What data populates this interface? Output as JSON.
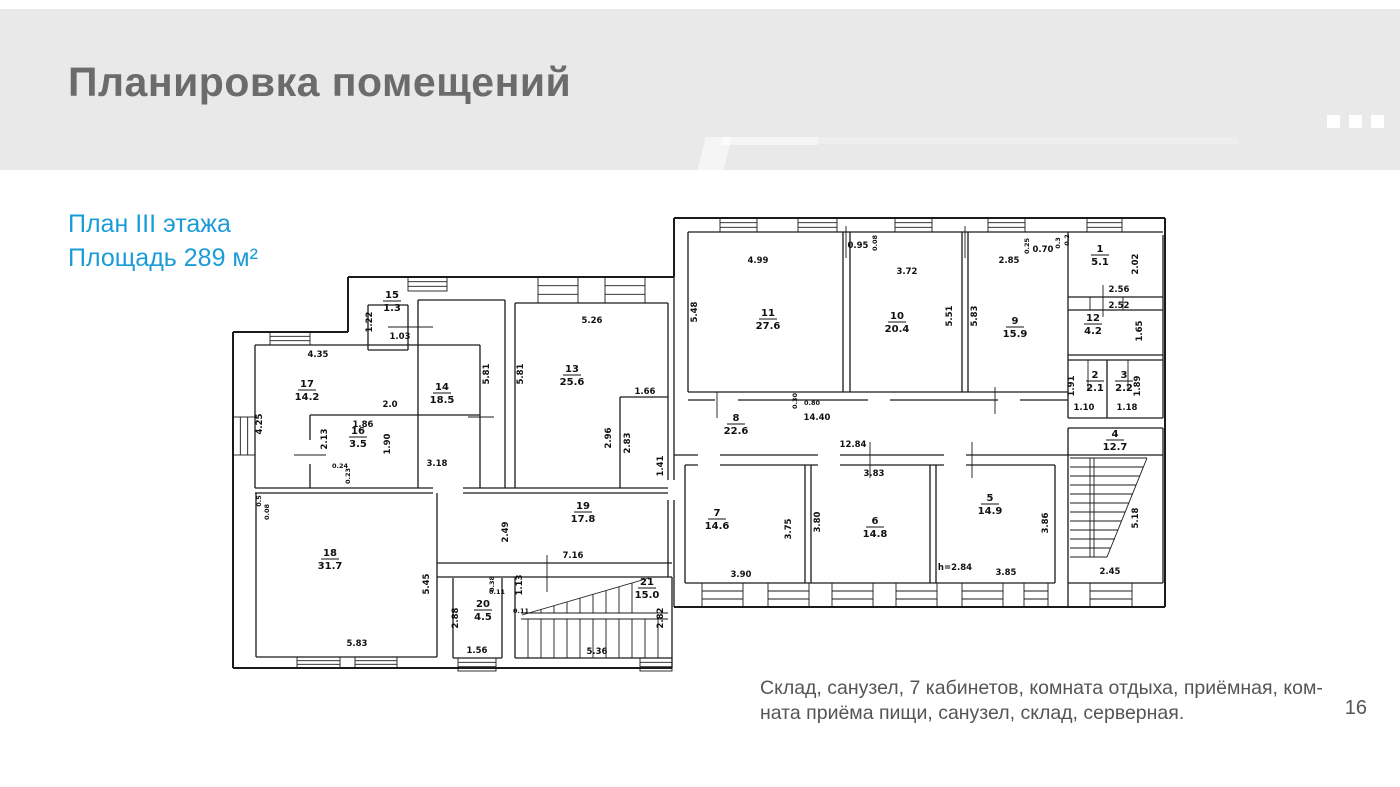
{
  "slide": {
    "title": "Планировка помещений",
    "subtitle_lines": [
      "План III этажа",
      "Площадь 289 м²"
    ],
    "caption_lines": [
      "Склад, санузел, 7 кабинетов, комната отдыха, приёмная, ком-",
      "ната приёма пищи, санузел, склад, серверная."
    ],
    "page_number": "16",
    "colors": {
      "accent": "#1b9cd8",
      "title": "#6b6b6b",
      "header_bg": "#e9e9e9",
      "caption": "#555555",
      "plan_line": "#1b1b1b"
    }
  },
  "floor_plan": {
    "rooms": [
      {
        "n": "17",
        "a": "14.2",
        "x": 79,
        "y": 185
      },
      {
        "n": "16",
        "a": "3.5",
        "x": 130,
        "y": 232
      },
      {
        "n": "15",
        "a": "1.3",
        "x": 164,
        "y": 96
      },
      {
        "n": "14",
        "a": "18.5",
        "x": 214,
        "y": 188
      },
      {
        "n": "13",
        "a": "25.6",
        "x": 344,
        "y": 170
      },
      {
        "n": "18",
        "a": "31.7",
        "x": 102,
        "y": 354
      },
      {
        "n": "19",
        "a": "17.8",
        "x": 355,
        "y": 307
      },
      {
        "n": "20",
        "a": "4.5",
        "x": 255,
        "y": 405
      },
      {
        "n": "21",
        "a": "15.0",
        "x": 419,
        "y": 383
      },
      {
        "n": "11",
        "a": "27.6",
        "x": 540,
        "y": 114
      },
      {
        "n": "10",
        "a": "20.4",
        "x": 669,
        "y": 117
      },
      {
        "n": "9",
        "a": "15.9",
        "x": 787,
        "y": 122
      },
      {
        "n": "8",
        "a": "22.6",
        "x": 508,
        "y": 219
      },
      {
        "n": "7",
        "a": "14.6",
        "x": 489,
        "y": 314
      },
      {
        "n": "6",
        "a": "14.8",
        "x": 647,
        "y": 322
      },
      {
        "n": "5",
        "a": "14.9",
        "x": 762,
        "y": 299
      },
      {
        "n": "4",
        "a": "12.7",
        "x": 887,
        "y": 235
      },
      {
        "n": "1",
        "a": "5.1",
        "x": 872,
        "y": 50
      },
      {
        "n": "12",
        "a": "4.2",
        "x": 865,
        "y": 119
      },
      {
        "n": "2",
        "a": "2.1",
        "x": 867,
        "y": 176
      },
      {
        "n": "3",
        "a": "2.2",
        "x": 896,
        "y": 176
      }
    ],
    "dimensions": [
      {
        "t": "4.35",
        "x": 90,
        "y": 155
      },
      {
        "t": "4.25",
        "x": 34,
        "y": 222,
        "r": 1
      },
      {
        "t": "2.0",
        "x": 162,
        "y": 205
      },
      {
        "t": "1.86",
        "x": 135,
        "y": 225
      },
      {
        "t": "2.13",
        "x": 99,
        "y": 237,
        "r": 1
      },
      {
        "t": "1.90",
        "x": 162,
        "y": 242,
        "r": 1
      },
      {
        "t": "0.24",
        "x": 112,
        "y": 266,
        "s": 1
      },
      {
        "t": "0.23",
        "x": 122,
        "y": 274,
        "r": 1,
        "s": 1
      },
      {
        "t": "1.22",
        "x": 144,
        "y": 120,
        "r": 1
      },
      {
        "t": "1.03",
        "x": 172,
        "y": 137
      },
      {
        "t": "5.81",
        "x": 261,
        "y": 172,
        "r": 1
      },
      {
        "t": "5.81",
        "x": 295,
        "y": 172,
        "r": 1
      },
      {
        "t": "3.18",
        "x": 209,
        "y": 264
      },
      {
        "t": "5.26",
        "x": 364,
        "y": 121
      },
      {
        "t": "1.66",
        "x": 417,
        "y": 192
      },
      {
        "t": "2.96",
        "x": 383,
        "y": 236,
        "r": 1
      },
      {
        "t": "2.83",
        "x": 402,
        "y": 241,
        "r": 1
      },
      {
        "t": "1.41",
        "x": 435,
        "y": 264,
        "r": 1
      },
      {
        "t": "5.48",
        "x": 469,
        "y": 110,
        "r": 1
      },
      {
        "t": "4.99",
        "x": 530,
        "y": 61
      },
      {
        "t": "3.72",
        "x": 679,
        "y": 72
      },
      {
        "t": "0.95",
        "x": 630,
        "y": 46
      },
      {
        "t": "0.08",
        "x": 649,
        "y": 41,
        "r": 1,
        "s": 1
      },
      {
        "t": "5.51",
        "x": 724,
        "y": 114,
        "r": 1
      },
      {
        "t": "5.83",
        "x": 749,
        "y": 114,
        "r": 1
      },
      {
        "t": "2.85",
        "x": 781,
        "y": 61
      },
      {
        "t": "0.70",
        "x": 815,
        "y": 50
      },
      {
        "t": "0.25",
        "x": 801,
        "y": 44,
        "r": 1,
        "s": 1
      },
      {
        "t": "0.3",
        "x": 832,
        "y": 41,
        "r": 1,
        "s": 1
      },
      {
        "t": "0.2",
        "x": 841,
        "y": 38,
        "r": 1,
        "s": 1
      },
      {
        "t": "2.02",
        "x": 910,
        "y": 62,
        "r": 1
      },
      {
        "t": "2.56",
        "x": 891,
        "y": 90
      },
      {
        "t": "2.52",
        "x": 891,
        "y": 106
      },
      {
        "t": "1.65",
        "x": 914,
        "y": 129,
        "r": 1
      },
      {
        "t": "1.91",
        "x": 846,
        "y": 184,
        "r": 1
      },
      {
        "t": "1.10",
        "x": 856,
        "y": 208
      },
      {
        "t": "1.89",
        "x": 912,
        "y": 184,
        "r": 1
      },
      {
        "t": "1.18",
        "x": 899,
        "y": 208
      },
      {
        "t": "14.40",
        "x": 589,
        "y": 218
      },
      {
        "t": "12.84",
        "x": 625,
        "y": 245
      },
      {
        "t": "0.30",
        "x": 569,
        "y": 199,
        "r": 1,
        "s": 1
      },
      {
        "t": "0.80",
        "x": 584,
        "y": 203,
        "s": 1
      },
      {
        "t": "3.83",
        "x": 646,
        "y": 274
      },
      {
        "t": "3.75",
        "x": 563,
        "y": 327,
        "r": 1
      },
      {
        "t": "3.80",
        "x": 592,
        "y": 320,
        "r": 1
      },
      {
        "t": "3.90",
        "x": 513,
        "y": 375
      },
      {
        "t": "3.86",
        "x": 820,
        "y": 321,
        "r": 1
      },
      {
        "t": "h=2.84",
        "x": 727,
        "y": 368
      },
      {
        "t": "3.85",
        "x": 778,
        "y": 373
      },
      {
        "t": "5.18",
        "x": 910,
        "y": 316,
        "r": 1
      },
      {
        "t": "2.45",
        "x": 882,
        "y": 372
      },
      {
        "t": "2.49",
        "x": 280,
        "y": 330,
        "r": 1
      },
      {
        "t": "7.16",
        "x": 345,
        "y": 356
      },
      {
        "t": "5.45",
        "x": 201,
        "y": 382,
        "r": 1
      },
      {
        "t": "0.5",
        "x": 33,
        "y": 299,
        "r": 1,
        "s": 1
      },
      {
        "t": "0.08",
        "x": 41,
        "y": 310,
        "r": 1,
        "s": 1
      },
      {
        "t": "5.83",
        "x": 129,
        "y": 444
      },
      {
        "t": "2.88",
        "x": 230,
        "y": 416,
        "r": 1
      },
      {
        "t": "1.56",
        "x": 249,
        "y": 451
      },
      {
        "t": "0.38",
        "x": 266,
        "y": 382,
        "r": 1,
        "s": 1
      },
      {
        "t": "0.11",
        "x": 269,
        "y": 392,
        "s": 1
      },
      {
        "t": "1.13",
        "x": 294,
        "y": 383,
        "r": 1
      },
      {
        "t": "0.11",
        "x": 293,
        "y": 411,
        "s": 1
      },
      {
        "t": "5.36",
        "x": 369,
        "y": 452
      },
      {
        "t": "2.82",
        "x": 435,
        "y": 416,
        "r": 1
      }
    ]
  }
}
